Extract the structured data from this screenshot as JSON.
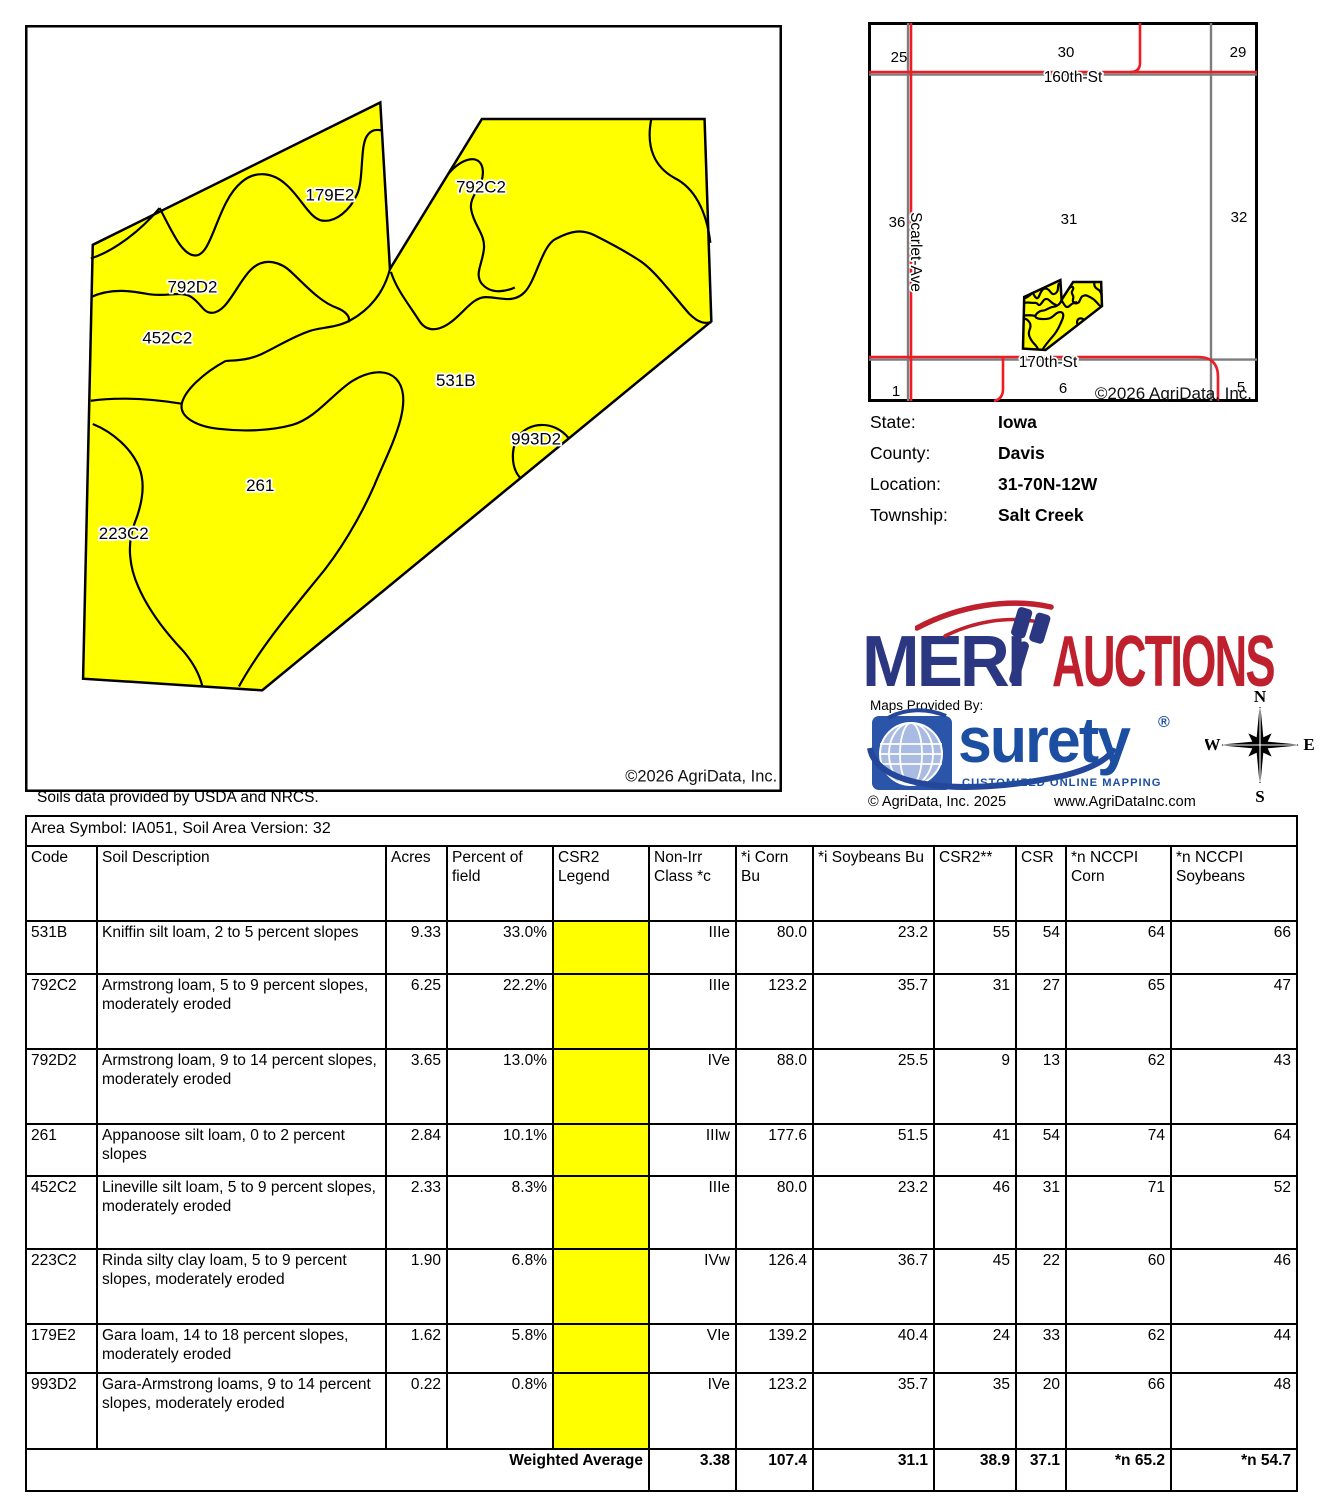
{
  "page": {
    "width": 1321,
    "height": 1500
  },
  "soil_map": {
    "copyright": "©2026 AgriData, Inc.",
    "region_labels": [
      {
        "code": "179E2",
        "x": 340,
        "y": 206
      },
      {
        "code": "792C2",
        "x": 496,
        "y": 198
      },
      {
        "code": "792D2",
        "x": 198,
        "y": 301
      },
      {
        "code": "452C2",
        "x": 172,
        "y": 354
      },
      {
        "code": "531B",
        "x": 470,
        "y": 398
      },
      {
        "code": "993D2",
        "x": 553,
        "y": 458
      },
      {
        "code": "261",
        "x": 268,
        "y": 506
      },
      {
        "code": "223C2",
        "x": 127,
        "y": 556
      }
    ]
  },
  "location_map": {
    "copyright": "©2026 AgriData, Inc.",
    "sections": [
      {
        "num": "25",
        "x": 899,
        "y": 57
      },
      {
        "num": "30",
        "x": 1066,
        "y": 52
      },
      {
        "num": "29",
        "x": 1238,
        "y": 52
      },
      {
        "num": "36",
        "x": 897,
        "y": 222
      },
      {
        "num": "31",
        "x": 1069,
        "y": 219
      },
      {
        "num": "32",
        "x": 1239,
        "y": 217
      },
      {
        "num": "1",
        "x": 896,
        "y": 391
      },
      {
        "num": "6",
        "x": 1063,
        "y": 388
      },
      {
        "num": "5",
        "x": 1241,
        "y": 387
      }
    ],
    "roads": [
      {
        "name": "160th-St",
        "x": 1073,
        "y": 77,
        "rotate": 0
      },
      {
        "name": "Scarlet-Ave",
        "x": 911,
        "y": 247,
        "rotate": 90
      },
      {
        "name": "170th-St",
        "x": 1048,
        "y": 362,
        "rotate": 0
      }
    ]
  },
  "location_info": {
    "rows": [
      {
        "label": "State:",
        "value": "Iowa"
      },
      {
        "label": "County:",
        "value": "Davis"
      },
      {
        "label": "Location:",
        "value": "31-70N-12W"
      },
      {
        "label": "Township:",
        "value": "Salt Creek"
      }
    ]
  },
  "branding": {
    "merit_left": "MERI",
    "merit_right": "AUCTIONS",
    "maps_provided_by": "Maps Provided By:",
    "surety_name": "surety",
    "surety_reg": "®",
    "surety_tagline": "CUSTOMIZED ONLINE MAPPING",
    "agridata_copyright": "© AgriData, Inc. 2025",
    "agridata_website": "www.AgriDataInc.com",
    "compass": {
      "n": "N",
      "e": "E",
      "s": "S",
      "w": "W"
    }
  },
  "soils_note": "Soils data provided by USDA and NRCS.",
  "table": {
    "area_header": "Area Symbol: IA051, Soil Area Version: 32",
    "columns": [
      "Code",
      "Soil Description",
      "Acres",
      "Percent of field",
      "CSR2 Legend",
      "Non-Irr Class *c",
      "*i Corn Bu",
      "*i Soybeans Bu",
      "CSR2**",
      "CSR",
      "*n NCCPI Corn",
      "*n NCCPI Soybeans"
    ],
    "rows": [
      {
        "code": "531B",
        "description": "Kniffin silt loam, 2 to 5 percent slopes",
        "acres": "9.33",
        "percent": "33.0%",
        "legend_color": "#ffff00",
        "non_irr_class": "IIIe",
        "corn_bu": "80.0",
        "soybeans_bu": "23.2",
        "csr2": "55",
        "csr": "54",
        "nccpi_corn": "64",
        "nccpi_soybeans": "66"
      },
      {
        "code": "792C2",
        "description": "Armstrong loam, 5 to 9 percent slopes, moderately eroded",
        "acres": "6.25",
        "percent": "22.2%",
        "legend_color": "#ffff00",
        "non_irr_class": "IIIe",
        "corn_bu": "123.2",
        "soybeans_bu": "35.7",
        "csr2": "31",
        "csr": "27",
        "nccpi_corn": "65",
        "nccpi_soybeans": "47"
      },
      {
        "code": "792D2",
        "description": "Armstrong loam, 9 to 14 percent slopes, moderately eroded",
        "acres": "3.65",
        "percent": "13.0%",
        "legend_color": "#ffff00",
        "non_irr_class": "IVe",
        "corn_bu": "88.0",
        "soybeans_bu": "25.5",
        "csr2": "9",
        "csr": "13",
        "nccpi_corn": "62",
        "nccpi_soybeans": "43"
      },
      {
        "code": "261",
        "description": "Appanoose silt loam, 0 to 2 percent slopes",
        "acres": "2.84",
        "percent": "10.1%",
        "legend_color": "#ffff00",
        "non_irr_class": "IIIw",
        "corn_bu": "177.6",
        "soybeans_bu": "51.5",
        "csr2": "41",
        "csr": "54",
        "nccpi_corn": "74",
        "nccpi_soybeans": "64"
      },
      {
        "code": "452C2",
        "description": "Lineville silt loam, 5 to 9 percent slopes, moderately eroded",
        "acres": "2.33",
        "percent": "8.3%",
        "legend_color": "#ffff00",
        "non_irr_class": "IIIe",
        "corn_bu": "80.0",
        "soybeans_bu": "23.2",
        "csr2": "46",
        "csr": "31",
        "nccpi_corn": "71",
        "nccpi_soybeans": "52"
      },
      {
        "code": "223C2",
        "description": "Rinda silty clay loam, 5 to 9 percent slopes, moderately eroded",
        "acres": "1.90",
        "percent": "6.8%",
        "legend_color": "#ffff00",
        "non_irr_class": "IVw",
        "corn_bu": "126.4",
        "soybeans_bu": "36.7",
        "csr2": "45",
        "csr": "22",
        "nccpi_corn": "60",
        "nccpi_soybeans": "46"
      },
      {
        "code": "179E2",
        "description": "Gara loam, 14 to 18 percent slopes, moderately eroded",
        "acres": "1.62",
        "percent": "5.8%",
        "legend_color": "#ffff00",
        "non_irr_class": "VIe",
        "corn_bu": "139.2",
        "soybeans_bu": "40.4",
        "csr2": "24",
        "csr": "33",
        "nccpi_corn": "62",
        "nccpi_soybeans": "44"
      },
      {
        "code": "993D2",
        "description": "Gara-Armstrong loams, 9 to 14 percent slopes, moderately eroded",
        "acres": "0.22",
        "percent": "0.8%",
        "legend_color": "#ffff00",
        "non_irr_class": "IVe",
        "corn_bu": "123.2",
        "soybeans_bu": "35.7",
        "csr2": "35",
        "csr": "20",
        "nccpi_corn": "66",
        "nccpi_soybeans": "48"
      }
    ],
    "weighted_average": {
      "label": "Weighted Average",
      "non_irr_class": "3.38",
      "corn_bu": "107.4",
      "soybeans_bu": "31.1",
      "csr2": "38.9",
      "csr": "37.1",
      "nccpi_corn": "*n 65.2",
      "nccpi_soybeans": "*n 54.7"
    }
  },
  "colors": {
    "field_yellow": "#ffff00",
    "road_red": "#ee1c25",
    "road_gray": "#7d7d7d",
    "merit_navy": "#2b3780",
    "merit_red": "#be202e",
    "surety_blue": "#1c4fa1",
    "surety_square": "#2b55a8"
  }
}
